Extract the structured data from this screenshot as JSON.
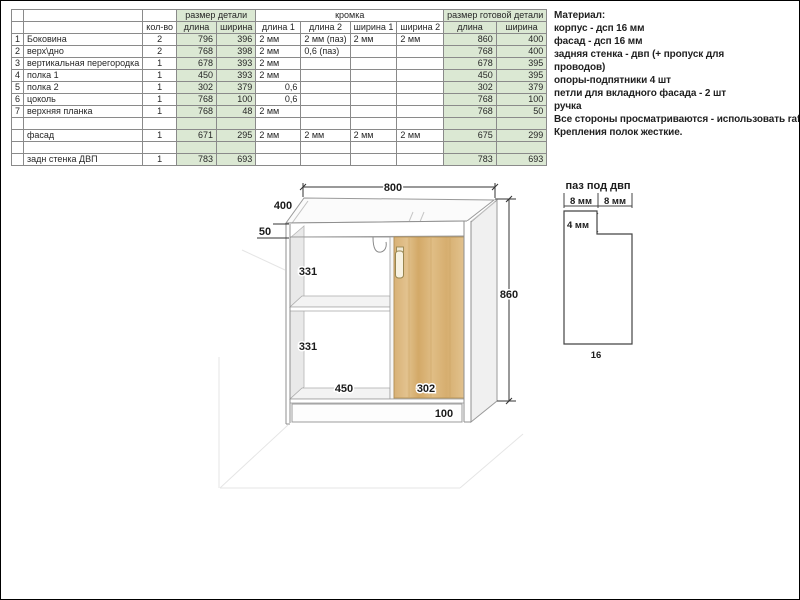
{
  "table": {
    "group_headers": [
      "размер детали",
      "кромка",
      "размер готовой детали"
    ],
    "sub_headers": [
      "кол-во",
      "длина",
      "ширина",
      "длина 1",
      "длина 2",
      "ширина 1",
      "ширина 2",
      "длина",
      "ширина"
    ],
    "rows": [
      [
        "1",
        "Боковина",
        "2",
        "796",
        "396",
        "2 мм",
        "2 мм (паз)",
        "2 мм",
        "2 мм",
        "860",
        "400"
      ],
      [
        "2",
        "верх\\дно",
        "2",
        "768",
        "398",
        "2 мм",
        "0,6 (паз)",
        "",
        "",
        "768",
        "400"
      ],
      [
        "3",
        "вертикальная перегородка",
        "1",
        "678",
        "393",
        "2 мм",
        "",
        "",
        "",
        "678",
        "395"
      ],
      [
        "4",
        "полка 1",
        "1",
        "450",
        "393",
        "2 мм",
        "",
        "",
        "",
        "450",
        "395"
      ],
      [
        "5",
        "полка 2",
        "1",
        "302",
        "379",
        "0,6",
        "",
        "",
        "",
        "302",
        "379"
      ],
      [
        "6",
        "цоколь",
        "1",
        "768",
        "100",
        "0,6",
        "",
        "",
        "",
        "768",
        "100"
      ],
      [
        "7",
        "верхняя планка",
        "1",
        "768",
        "48",
        "2 мм",
        "",
        "",
        "",
        "768",
        "50"
      ],
      [
        "",
        "",
        "",
        "",
        "",
        "",
        "",
        "",
        "",
        "",
        ""
      ],
      [
        "",
        "фасад",
        "1",
        "671",
        "295",
        "2 мм",
        "2 мм",
        "2 мм",
        "2 мм",
        "675",
        "299"
      ],
      [
        "",
        "",
        "",
        "",
        "",
        "",
        "",
        "",
        "",
        "",
        ""
      ],
      [
        "",
        "задн стенка ДВП",
        "1",
        "783",
        "693",
        "",
        "",
        "",
        "",
        "783",
        "693"
      ]
    ]
  },
  "notes": {
    "lines": [
      "Материал:",
      "корпус - дсп 16 мм",
      "фасад - дсп 16 мм",
      "задняя стенка - двп (+ пропуск для",
      "проводов)",
      "опоры-подпятники 4 шт",
      "петли для вкладного фасада - 2 шт",
      "ручка",
      "Все стороны просматриваются - использовать rafix",
      "Крепления полок жесткие."
    ]
  },
  "drawing": {
    "dims": {
      "width": "800",
      "depth": "400",
      "top_strip": "50",
      "shelf_gap_1": "331",
      "shelf_gap_2": "331",
      "left_compartment": "450",
      "door_width": "302",
      "plinth": "100",
      "height": "860"
    },
    "groove": {
      "title": "паз под двп",
      "left": "8 мм",
      "right": "8 мм",
      "depth": "4 мм",
      "thickness": "16"
    }
  },
  "colors": {
    "table_green": "#dbe8d3",
    "wood": "#dcb87e",
    "outline_gray": "#999999",
    "dimension_black": "#1b1b1b"
  }
}
